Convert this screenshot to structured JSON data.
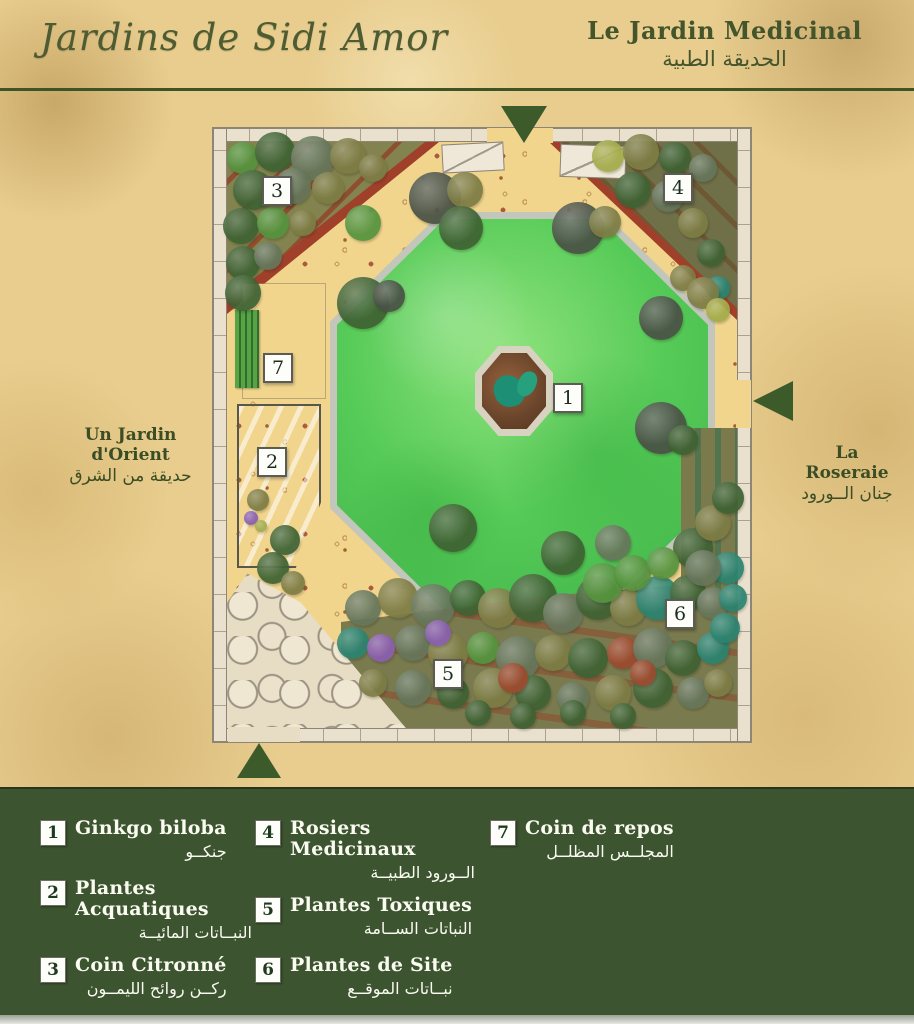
{
  "header": {
    "title": "Jardins de Sidi Amor",
    "subtitle_fr": "Le Jardin Medicinal",
    "subtitle_ar": "الحديقة الطبية"
  },
  "side_labels": {
    "left_fr": "Un Jardin d'Orient",
    "left_ar": "حديقة من الشرق",
    "right_fr": "La Roseraie",
    "right_ar": "جنان الــورود"
  },
  "map": {
    "markers": [
      "1",
      "2",
      "3",
      "4",
      "5",
      "6",
      "7"
    ]
  },
  "legend": {
    "items": [
      {
        "num": "1",
        "fr": "Ginkgo biloba",
        "ar": "جنكــو"
      },
      {
        "num": "2",
        "fr": "Plantes Acquatiques",
        "ar": "النبــاتات المائيــة"
      },
      {
        "num": "3",
        "fr": "Coin Citronné",
        "ar": "ركــن روائح الليمــون"
      },
      {
        "num": "4",
        "fr": "Rosiers Medicinaux",
        "ar": "الــورود الطبيــة"
      },
      {
        "num": "5",
        "fr": "Plantes Toxiques",
        "ar": "النباتات الســامة"
      },
      {
        "num": "6",
        "fr": "Plantes de Site",
        "ar": "نبــاتات الموقــع"
      },
      {
        "num": "7",
        "fr": "Coin de repos",
        "ar": "المجلــس المظلــل"
      }
    ]
  },
  "colors": {
    "title_green": "#4e5c33",
    "legend_bg": "#3c5530",
    "entrance_triangle": "#3d5a2b",
    "lawn_green": "#57cb58",
    "sand": "#f2d58d",
    "brick_red": "#a0402a"
  }
}
